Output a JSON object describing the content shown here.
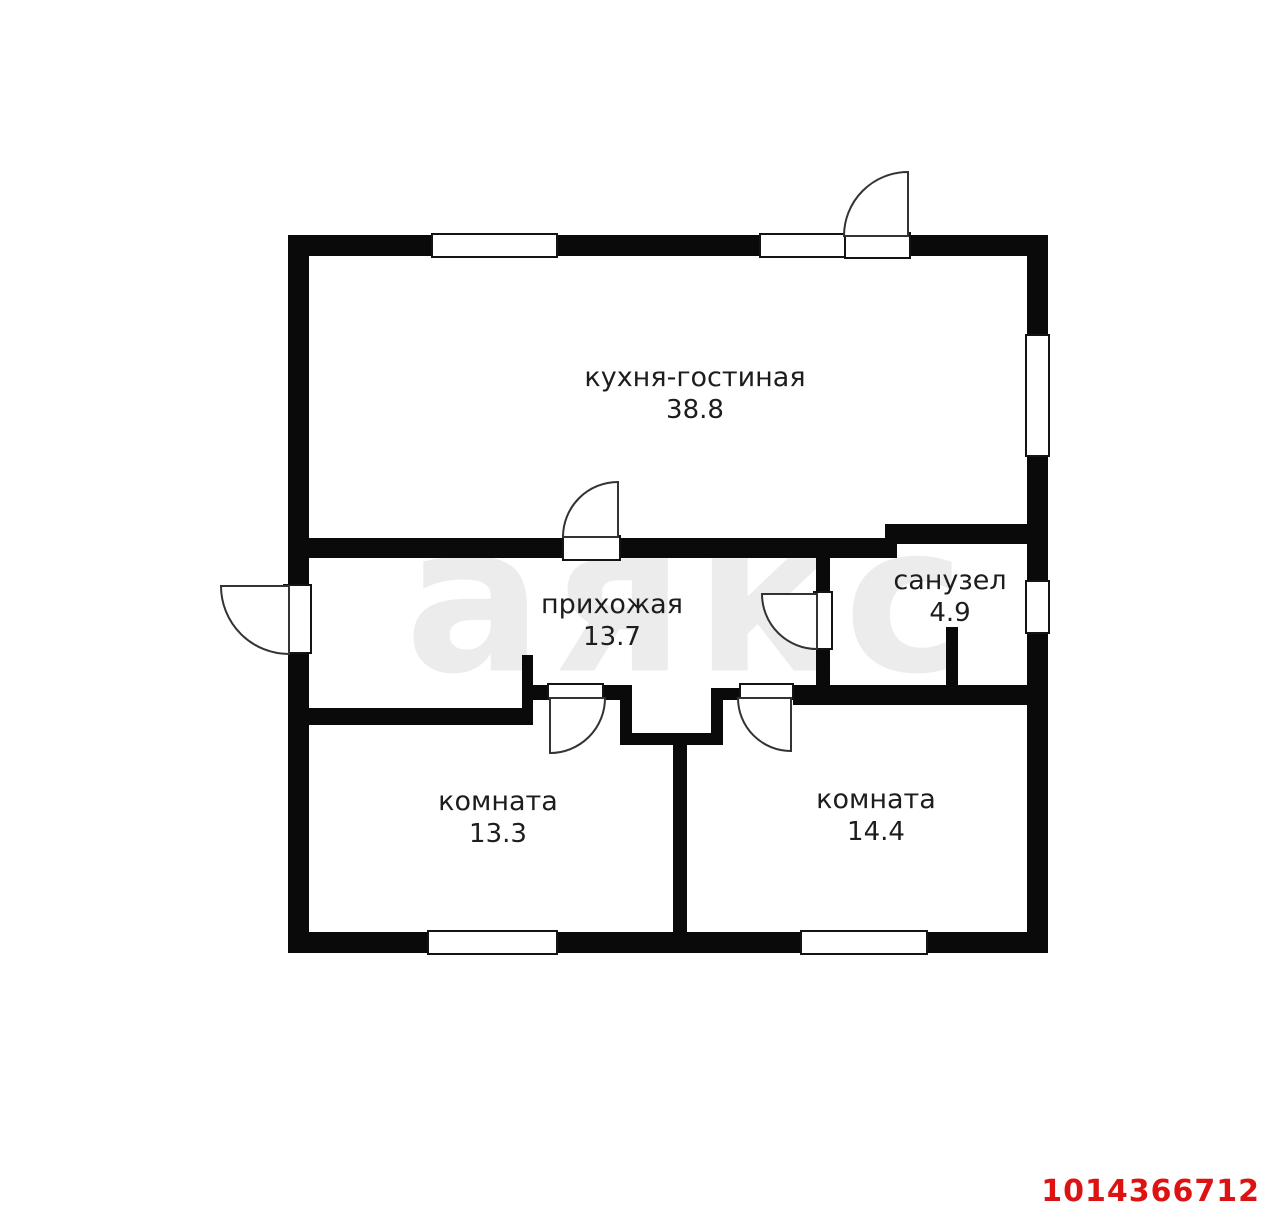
{
  "watermark": {
    "text": "аякс"
  },
  "plan_id": "1014366712",
  "colors": {
    "wall": "#0a0a0a",
    "label": "#1d1d1d",
    "watermark": "#ececec",
    "plan_id_red": "#dd1212",
    "background": "#ffffff"
  },
  "rooms": [
    {
      "name": "кухня-гостиная",
      "area": "38.8"
    },
    {
      "name": "прихожая",
      "area": "13.7"
    },
    {
      "name": "санузел",
      "area": "4.9"
    },
    {
      "name": "комната",
      "area": "13.3"
    },
    {
      "name": "комната",
      "area": "14.4"
    }
  ]
}
